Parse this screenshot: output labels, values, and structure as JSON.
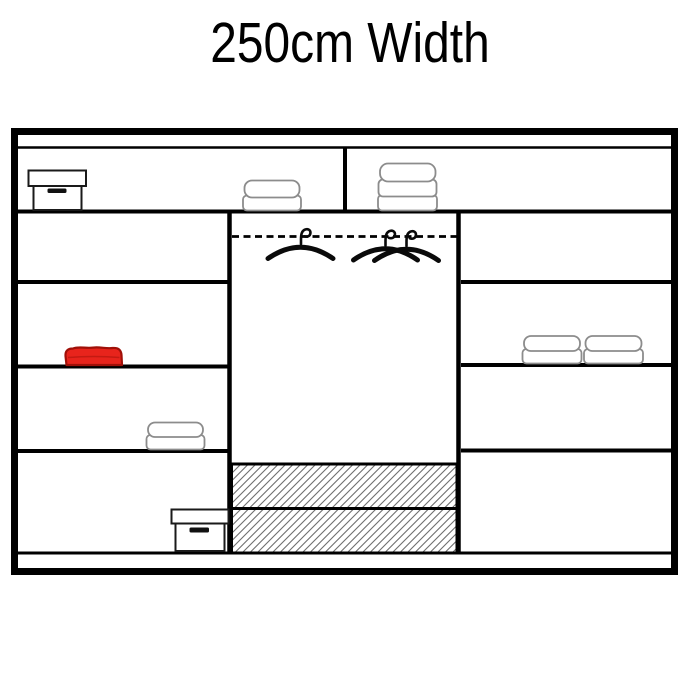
{
  "title": "250cm Width",
  "colors": {
    "background": "#ffffff",
    "outline": "#000000",
    "towel_outline": "#8c8c8c",
    "hatch_line": "#6e6e6e",
    "red_item_fill": "#e8241c",
    "red_item_stroke": "#a01008"
  },
  "wardrobe": {
    "label": "wardrobe interior layout diagram",
    "top_shelf": {
      "items": [
        "storage-box-icon",
        "folded-towel-stack-2-icon",
        "folded-towel-stack-3-icon"
      ]
    },
    "left_column": {
      "shelf_rows": 4,
      "items": [
        "red-folded-towel-icon",
        "folded-towel-stack-2-icon",
        "storage-box-icon"
      ]
    },
    "middle_column": {
      "items": [
        "hanging-rail",
        "hanger-icon",
        "crossed-hangers-icon",
        "hatched-drawer",
        "hatched-drawer"
      ]
    },
    "right_column": {
      "shelf_rows": 4,
      "items": [
        "folded-towel-stack-2-icon",
        "folded-towel-stack-2-icon"
      ]
    }
  }
}
